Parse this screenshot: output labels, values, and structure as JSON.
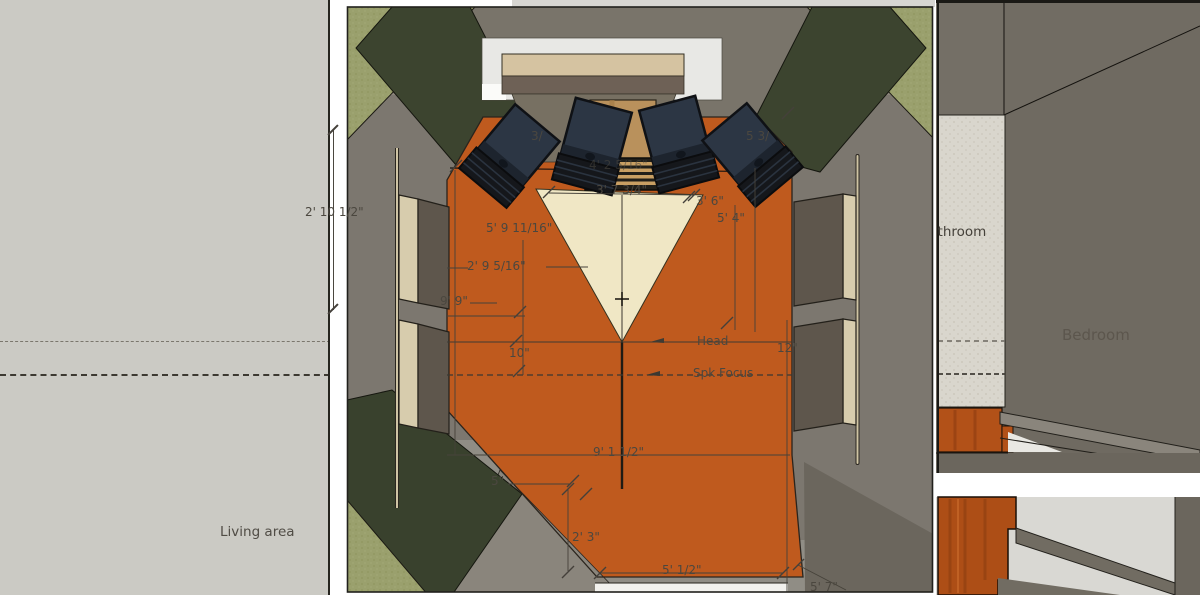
{
  "labels": {
    "living_area": "Living area",
    "bedroom": "Bedroom",
    "bathroom": "Bathroom",
    "head": "Head",
    "spk_focus": "Spk Focus"
  },
  "dims": {
    "left_wall_offset": "2' 10 1/2\"",
    "frag_left": "3/",
    "frag_right": "5 3/",
    "desk_width": "4' 2 5/16\"",
    "triangle_base": "3' 7 3/4\"",
    "right_upper": "3' 6\"",
    "right_side": "5' 4\"",
    "left_side": "5' 9 11/16\"",
    "left_mid": "2' 9 5/16\"",
    "panel_gap": "9' 9\"",
    "ten": "10\"",
    "twelve": "12\"",
    "room_width": "9' 1 1/2\"",
    "five": "5\"",
    "bottom_height": "2' 3\"",
    "bottom_width": "5' 1/2\"",
    "bottom_right": "5' 7\""
  },
  "colors": {
    "floor_orange": "#bf5a1e",
    "listening_triangle_cream": "#f0e7c5",
    "absorber_olive_light": "#9aa06d",
    "absorber_olive_dark": "#3c442f",
    "speaker_navy": "#2c3644",
    "wood_desk": "#b9915c",
    "wall_gray": "#7c776f",
    "living_panel_gray": "#cbcac4",
    "bedroom_wood_floor": "#b25118",
    "tile_light": "#d9d6cd"
  }
}
